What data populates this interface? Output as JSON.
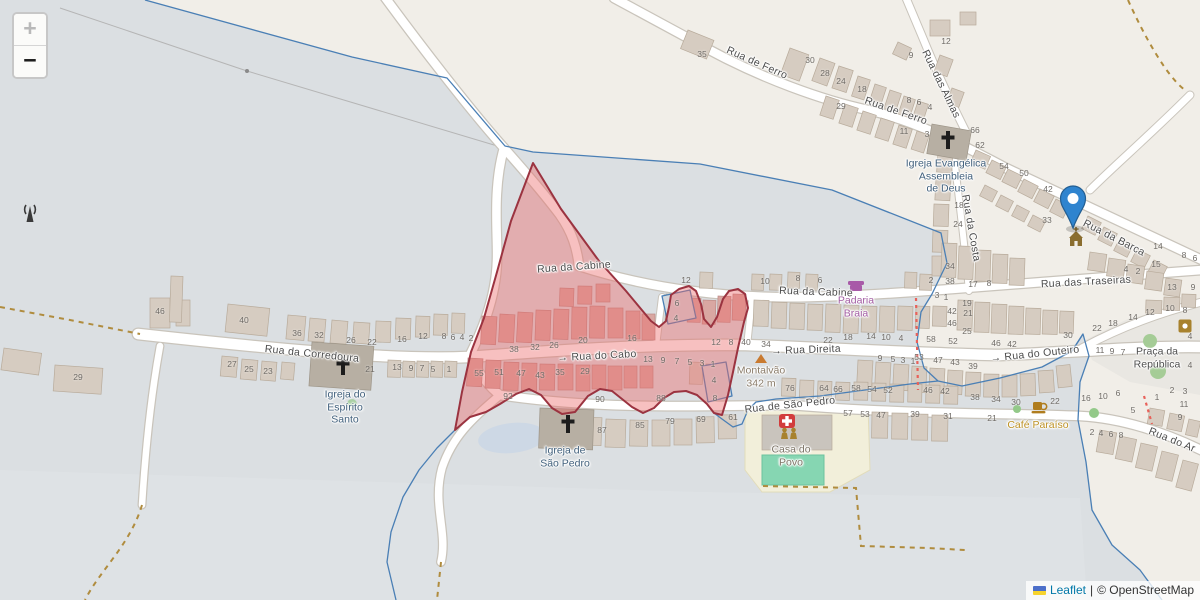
{
  "map": {
    "controls": {
      "zoom_in": "+",
      "zoom_out": "−"
    },
    "attribution": {
      "leaflet_link": "Leaflet",
      "separator": "|",
      "copyright": "© OpenStreetMap",
      "flag_icon": "ukraine-flag-icon"
    },
    "marker": {
      "icon": "map-marker",
      "street": "Rua da Barca"
    },
    "colors": {
      "highlight_fill": "#ed6a6a",
      "highlight_border": "#9b3340",
      "boundary_blue": "#4a7fb5",
      "marker_blue": "#2f84cf",
      "link_blue": "#0078a8",
      "track_dash": "#b08c3e",
      "construction_red": "#e8615a"
    },
    "streets": [
      {
        "label": "Rua da Cabine",
        "x": 574,
        "y": 267,
        "rot": -4
      },
      {
        "label": "Rua da Cabine",
        "x": 816,
        "y": 292,
        "rot": 2
      },
      {
        "label": "Rua das Traseiras",
        "x": 1086,
        "y": 282,
        "rot": -3
      },
      {
        "label": "Rua de Ferro",
        "x": 757,
        "y": 63,
        "rot": 24
      },
      {
        "label": "Rua de Ferro",
        "x": 896,
        "y": 111,
        "rot": 19
      },
      {
        "label": "Rua das Almas",
        "x": 941,
        "y": 84,
        "rot": 64
      },
      {
        "label": "Rua da Costa",
        "x": 971,
        "y": 228,
        "rot": 80
      },
      {
        "label": "Rua da Barca",
        "x": 1114,
        "y": 238,
        "rot": 27
      },
      {
        "label": "Rua da Corredoura",
        "x": 312,
        "y": 354,
        "rot": 6
      },
      {
        "label": "→ Rua do Cabo",
        "x": 597,
        "y": 356,
        "rot": -3
      },
      {
        "label": "→ Rua Direita",
        "x": 806,
        "y": 350,
        "rot": -2
      },
      {
        "label": "→ Rua do Outeiro",
        "x": 1035,
        "y": 354,
        "rot": -6
      },
      {
        "label": "Rua de São Pedro",
        "x": 790,
        "y": 405,
        "rot": -6
      },
      {
        "label": "Rua do Ar",
        "x": 1172,
        "y": 440,
        "rot": 22
      }
    ],
    "pois": [
      {
        "lines": [
          "Igreja Evangélica",
          "Assembleia",
          "de Deus"
        ],
        "x": 946,
        "y": 176,
        "color": "#41607c",
        "icon": "church-cross-icon"
      },
      {
        "lines": [
          "Igreja do",
          "Espírito",
          "Santo"
        ],
        "x": 345,
        "y": 407,
        "color": "#41607c",
        "icon": "church-cross-icon"
      },
      {
        "lines": [
          "Igreja de",
          "São Pedro"
        ],
        "x": 565,
        "y": 457,
        "color": "#41607c",
        "icon": "church-cross-icon"
      },
      {
        "lines": [
          "Padaria",
          "Braia"
        ],
        "x": 856,
        "y": 307,
        "color": "#a25ca3",
        "icon": "bakery-shop-icon"
      },
      {
        "lines": [
          "Café Paraíso"
        ],
        "x": 1038,
        "y": 425,
        "color": "#bd9226",
        "icon": "cafe-icon"
      },
      {
        "lines": [
          "Casa do",
          "Povo"
        ],
        "x": 791,
        "y": 456,
        "color": "#7d7466",
        "icon": "community-people-icon"
      },
      {
        "lines": [
          "Montalvão",
          "342 m"
        ],
        "x": 761,
        "y": 377,
        "color": "#8a7c6a",
        "icon": "peak-icon"
      },
      {
        "lines": [
          "Praça da",
          "República"
        ],
        "x": 1157,
        "y": 358,
        "color": "#4f4f4f",
        "icon": ""
      }
    ],
    "house_numbers": [
      {
        "t": "35",
        "x": 702,
        "y": 54
      },
      {
        "t": "30",
        "x": 810,
        "y": 60
      },
      {
        "t": "28",
        "x": 825,
        "y": 73
      },
      {
        "t": "24",
        "x": 841,
        "y": 81
      },
      {
        "t": "18",
        "x": 862,
        "y": 89
      },
      {
        "t": "29",
        "x": 841,
        "y": 106
      },
      {
        "t": "9",
        "x": 911,
        "y": 55
      },
      {
        "t": "12",
        "x": 946,
        "y": 41
      },
      {
        "t": "8",
        "x": 909,
        "y": 100
      },
      {
        "t": "6",
        "x": 919,
        "y": 102
      },
      {
        "t": "4",
        "x": 930,
        "y": 107
      },
      {
        "t": "11",
        "x": 904,
        "y": 131
      },
      {
        "t": "3",
        "x": 927,
        "y": 134
      },
      {
        "t": "66",
        "x": 975,
        "y": 130
      },
      {
        "t": "62",
        "x": 980,
        "y": 145
      },
      {
        "t": "54",
        "x": 1004,
        "y": 166
      },
      {
        "t": "50",
        "x": 1024,
        "y": 173
      },
      {
        "t": "42",
        "x": 1048,
        "y": 189
      },
      {
        "t": "33",
        "x": 1047,
        "y": 220
      },
      {
        "t": "18",
        "x": 959,
        "y": 205
      },
      {
        "t": "24",
        "x": 958,
        "y": 224
      },
      {
        "t": "34",
        "x": 950,
        "y": 266
      },
      {
        "t": "38",
        "x": 950,
        "y": 281
      },
      {
        "t": "2",
        "x": 931,
        "y": 280
      },
      {
        "t": "17",
        "x": 973,
        "y": 284
      },
      {
        "t": "8",
        "x": 989,
        "y": 283
      },
      {
        "t": "14",
        "x": 1158,
        "y": 246
      },
      {
        "t": "8",
        "x": 1184,
        "y": 255
      },
      {
        "t": "6",
        "x": 1195,
        "y": 258
      },
      {
        "t": "15",
        "x": 1156,
        "y": 264
      },
      {
        "t": "4",
        "x": 1126,
        "y": 269
      },
      {
        "t": "2",
        "x": 1138,
        "y": 271
      },
      {
        "t": "13",
        "x": 1172,
        "y": 287
      },
      {
        "t": "9",
        "x": 1193,
        "y": 287
      },
      {
        "t": "12",
        "x": 1150,
        "y": 312
      },
      {
        "t": "10",
        "x": 1170,
        "y": 308
      },
      {
        "t": "8",
        "x": 1185,
        "y": 310
      },
      {
        "t": "14",
        "x": 1133,
        "y": 317
      },
      {
        "t": "18",
        "x": 1113,
        "y": 323
      },
      {
        "t": "22",
        "x": 1097,
        "y": 328
      },
      {
        "t": "30",
        "x": 1068,
        "y": 335
      },
      {
        "t": "46",
        "x": 996,
        "y": 343
      },
      {
        "t": "42",
        "x": 1012,
        "y": 344
      },
      {
        "t": "19",
        "x": 967,
        "y": 303
      },
      {
        "t": "42",
        "x": 952,
        "y": 311
      },
      {
        "t": "21",
        "x": 968,
        "y": 313
      },
      {
        "t": "46",
        "x": 952,
        "y": 323
      },
      {
        "t": "25",
        "x": 967,
        "y": 331
      },
      {
        "t": "58",
        "x": 931,
        "y": 339
      },
      {
        "t": "52",
        "x": 953,
        "y": 341
      },
      {
        "t": "22",
        "x": 828,
        "y": 340
      },
      {
        "t": "18",
        "x": 848,
        "y": 337
      },
      {
        "t": "14",
        "x": 871,
        "y": 336
      },
      {
        "t": "10",
        "x": 886,
        "y": 337
      },
      {
        "t": "4",
        "x": 901,
        "y": 338
      },
      {
        "t": "40",
        "x": 746,
        "y": 342
      },
      {
        "t": "34",
        "x": 766,
        "y": 344
      },
      {
        "t": "10",
        "x": 765,
        "y": 281
      },
      {
        "t": "8",
        "x": 798,
        "y": 278
      },
      {
        "t": "6",
        "x": 820,
        "y": 280
      },
      {
        "t": "12",
        "x": 686,
        "y": 280
      },
      {
        "t": "3",
        "x": 937,
        "y": 295
      },
      {
        "t": "1",
        "x": 946,
        "y": 297
      },
      {
        "t": "12",
        "x": 716,
        "y": 342
      },
      {
        "t": "8",
        "x": 731,
        "y": 342
      },
      {
        "t": "16",
        "x": 632,
        "y": 338
      },
      {
        "t": "20",
        "x": 583,
        "y": 340
      },
      {
        "t": "26",
        "x": 554,
        "y": 345
      },
      {
        "t": "32",
        "x": 535,
        "y": 347
      },
      {
        "t": "38",
        "x": 514,
        "y": 349
      },
      {
        "t": "9",
        "x": 880,
        "y": 358
      },
      {
        "t": "5",
        "x": 893,
        "y": 359
      },
      {
        "t": "3",
        "x": 903,
        "y": 360
      },
      {
        "t": "1",
        "x": 913,
        "y": 361
      },
      {
        "t": "53",
        "x": 919,
        "y": 357
      },
      {
        "t": "47",
        "x": 938,
        "y": 360
      },
      {
        "t": "43",
        "x": 955,
        "y": 362
      },
      {
        "t": "39",
        "x": 973,
        "y": 366
      },
      {
        "t": "11",
        "x": 1100,
        "y": 350
      },
      {
        "t": "9",
        "x": 1112,
        "y": 351
      },
      {
        "t": "7",
        "x": 1123,
        "y": 352
      },
      {
        "t": "13",
        "x": 648,
        "y": 359
      },
      {
        "t": "9",
        "x": 663,
        "y": 360
      },
      {
        "t": "7",
        "x": 677,
        "y": 361
      },
      {
        "t": "5",
        "x": 690,
        "y": 362
      },
      {
        "t": "3",
        "x": 702,
        "y": 363
      },
      {
        "t": "1",
        "x": 713,
        "y": 364
      },
      {
        "t": "55",
        "x": 479,
        "y": 373
      },
      {
        "t": "51",
        "x": 499,
        "y": 372
      },
      {
        "t": "47",
        "x": 521,
        "y": 373
      },
      {
        "t": "43",
        "x": 540,
        "y": 375
      },
      {
        "t": "35",
        "x": 560,
        "y": 372
      },
      {
        "t": "29",
        "x": 585,
        "y": 371
      },
      {
        "t": "92",
        "x": 508,
        "y": 396
      },
      {
        "t": "90",
        "x": 600,
        "y": 399
      },
      {
        "t": "88",
        "x": 661,
        "y": 398
      },
      {
        "t": "6",
        "x": 677,
        "y": 303
      },
      {
        "t": "4",
        "x": 676,
        "y": 318
      },
      {
        "t": "4",
        "x": 714,
        "y": 380
      },
      {
        "t": "8",
        "x": 715,
        "y": 398
      },
      {
        "t": "46",
        "x": 160,
        "y": 311
      },
      {
        "t": "40",
        "x": 244,
        "y": 320
      },
      {
        "t": "36",
        "x": 297,
        "y": 333
      },
      {
        "t": "32",
        "x": 319,
        "y": 335
      },
      {
        "t": "26",
        "x": 351,
        "y": 340
      },
      {
        "t": "22",
        "x": 372,
        "y": 342
      },
      {
        "t": "16",
        "x": 402,
        "y": 339
      },
      {
        "t": "12",
        "x": 423,
        "y": 336
      },
      {
        "t": "8",
        "x": 444,
        "y": 336
      },
      {
        "t": "6",
        "x": 453,
        "y": 337
      },
      {
        "t": "4",
        "x": 462,
        "y": 337
      },
      {
        "t": "2",
        "x": 471,
        "y": 338
      },
      {
        "t": "27",
        "x": 232,
        "y": 364
      },
      {
        "t": "25",
        "x": 249,
        "y": 369
      },
      {
        "t": "23",
        "x": 268,
        "y": 371
      },
      {
        "t": "21",
        "x": 370,
        "y": 369
      },
      {
        "t": "13",
        "x": 397,
        "y": 367
      },
      {
        "t": "9",
        "x": 411,
        "y": 368
      },
      {
        "t": "7",
        "x": 422,
        "y": 368
      },
      {
        "t": "5",
        "x": 433,
        "y": 369
      },
      {
        "t": "1",
        "x": 449,
        "y": 369
      },
      {
        "t": "29",
        "x": 78,
        "y": 377
      },
      {
        "t": "87",
        "x": 602,
        "y": 430
      },
      {
        "t": "85",
        "x": 640,
        "y": 425
      },
      {
        "t": "79",
        "x": 670,
        "y": 421
      },
      {
        "t": "69",
        "x": 701,
        "y": 419
      },
      {
        "t": "61",
        "x": 733,
        "y": 417
      },
      {
        "t": "57",
        "x": 848,
        "y": 413
      },
      {
        "t": "53",
        "x": 865,
        "y": 414
      },
      {
        "t": "47",
        "x": 881,
        "y": 415
      },
      {
        "t": "39",
        "x": 915,
        "y": 414
      },
      {
        "t": "31",
        "x": 948,
        "y": 416
      },
      {
        "t": "76",
        "x": 790,
        "y": 388
      },
      {
        "t": "64",
        "x": 824,
        "y": 388
      },
      {
        "t": "66",
        "x": 838,
        "y": 389
      },
      {
        "t": "58",
        "x": 856,
        "y": 388
      },
      {
        "t": "54",
        "x": 872,
        "y": 389
      },
      {
        "t": "52",
        "x": 888,
        "y": 390
      },
      {
        "t": "46",
        "x": 928,
        "y": 390
      },
      {
        "t": "42",
        "x": 945,
        "y": 391
      },
      {
        "t": "38",
        "x": 975,
        "y": 397
      },
      {
        "t": "34",
        "x": 996,
        "y": 399
      },
      {
        "t": "30",
        "x": 1016,
        "y": 402
      },
      {
        "t": "22",
        "x": 1055,
        "y": 401
      },
      {
        "t": "16",
        "x": 1086,
        "y": 398
      },
      {
        "t": "10",
        "x": 1103,
        "y": 396
      },
      {
        "t": "6",
        "x": 1118,
        "y": 393
      },
      {
        "t": "21",
        "x": 992,
        "y": 418
      },
      {
        "t": "1",
        "x": 1157,
        "y": 397
      },
      {
        "t": "5",
        "x": 1133,
        "y": 410
      },
      {
        "t": "2",
        "x": 1172,
        "y": 390
      },
      {
        "t": "3",
        "x": 1185,
        "y": 391
      },
      {
        "t": "11",
        "x": 1184,
        "y": 404
      },
      {
        "t": "9",
        "x": 1180,
        "y": 417
      },
      {
        "t": "2",
        "x": 1092,
        "y": 432
      },
      {
        "t": "4",
        "x": 1101,
        "y": 433
      },
      {
        "t": "6",
        "x": 1111,
        "y": 434
      },
      {
        "t": "8",
        "x": 1121,
        "y": 435
      },
      {
        "t": "4",
        "x": 1190,
        "y": 336
      },
      {
        "t": "4",
        "x": 1190,
        "y": 365
      }
    ]
  }
}
